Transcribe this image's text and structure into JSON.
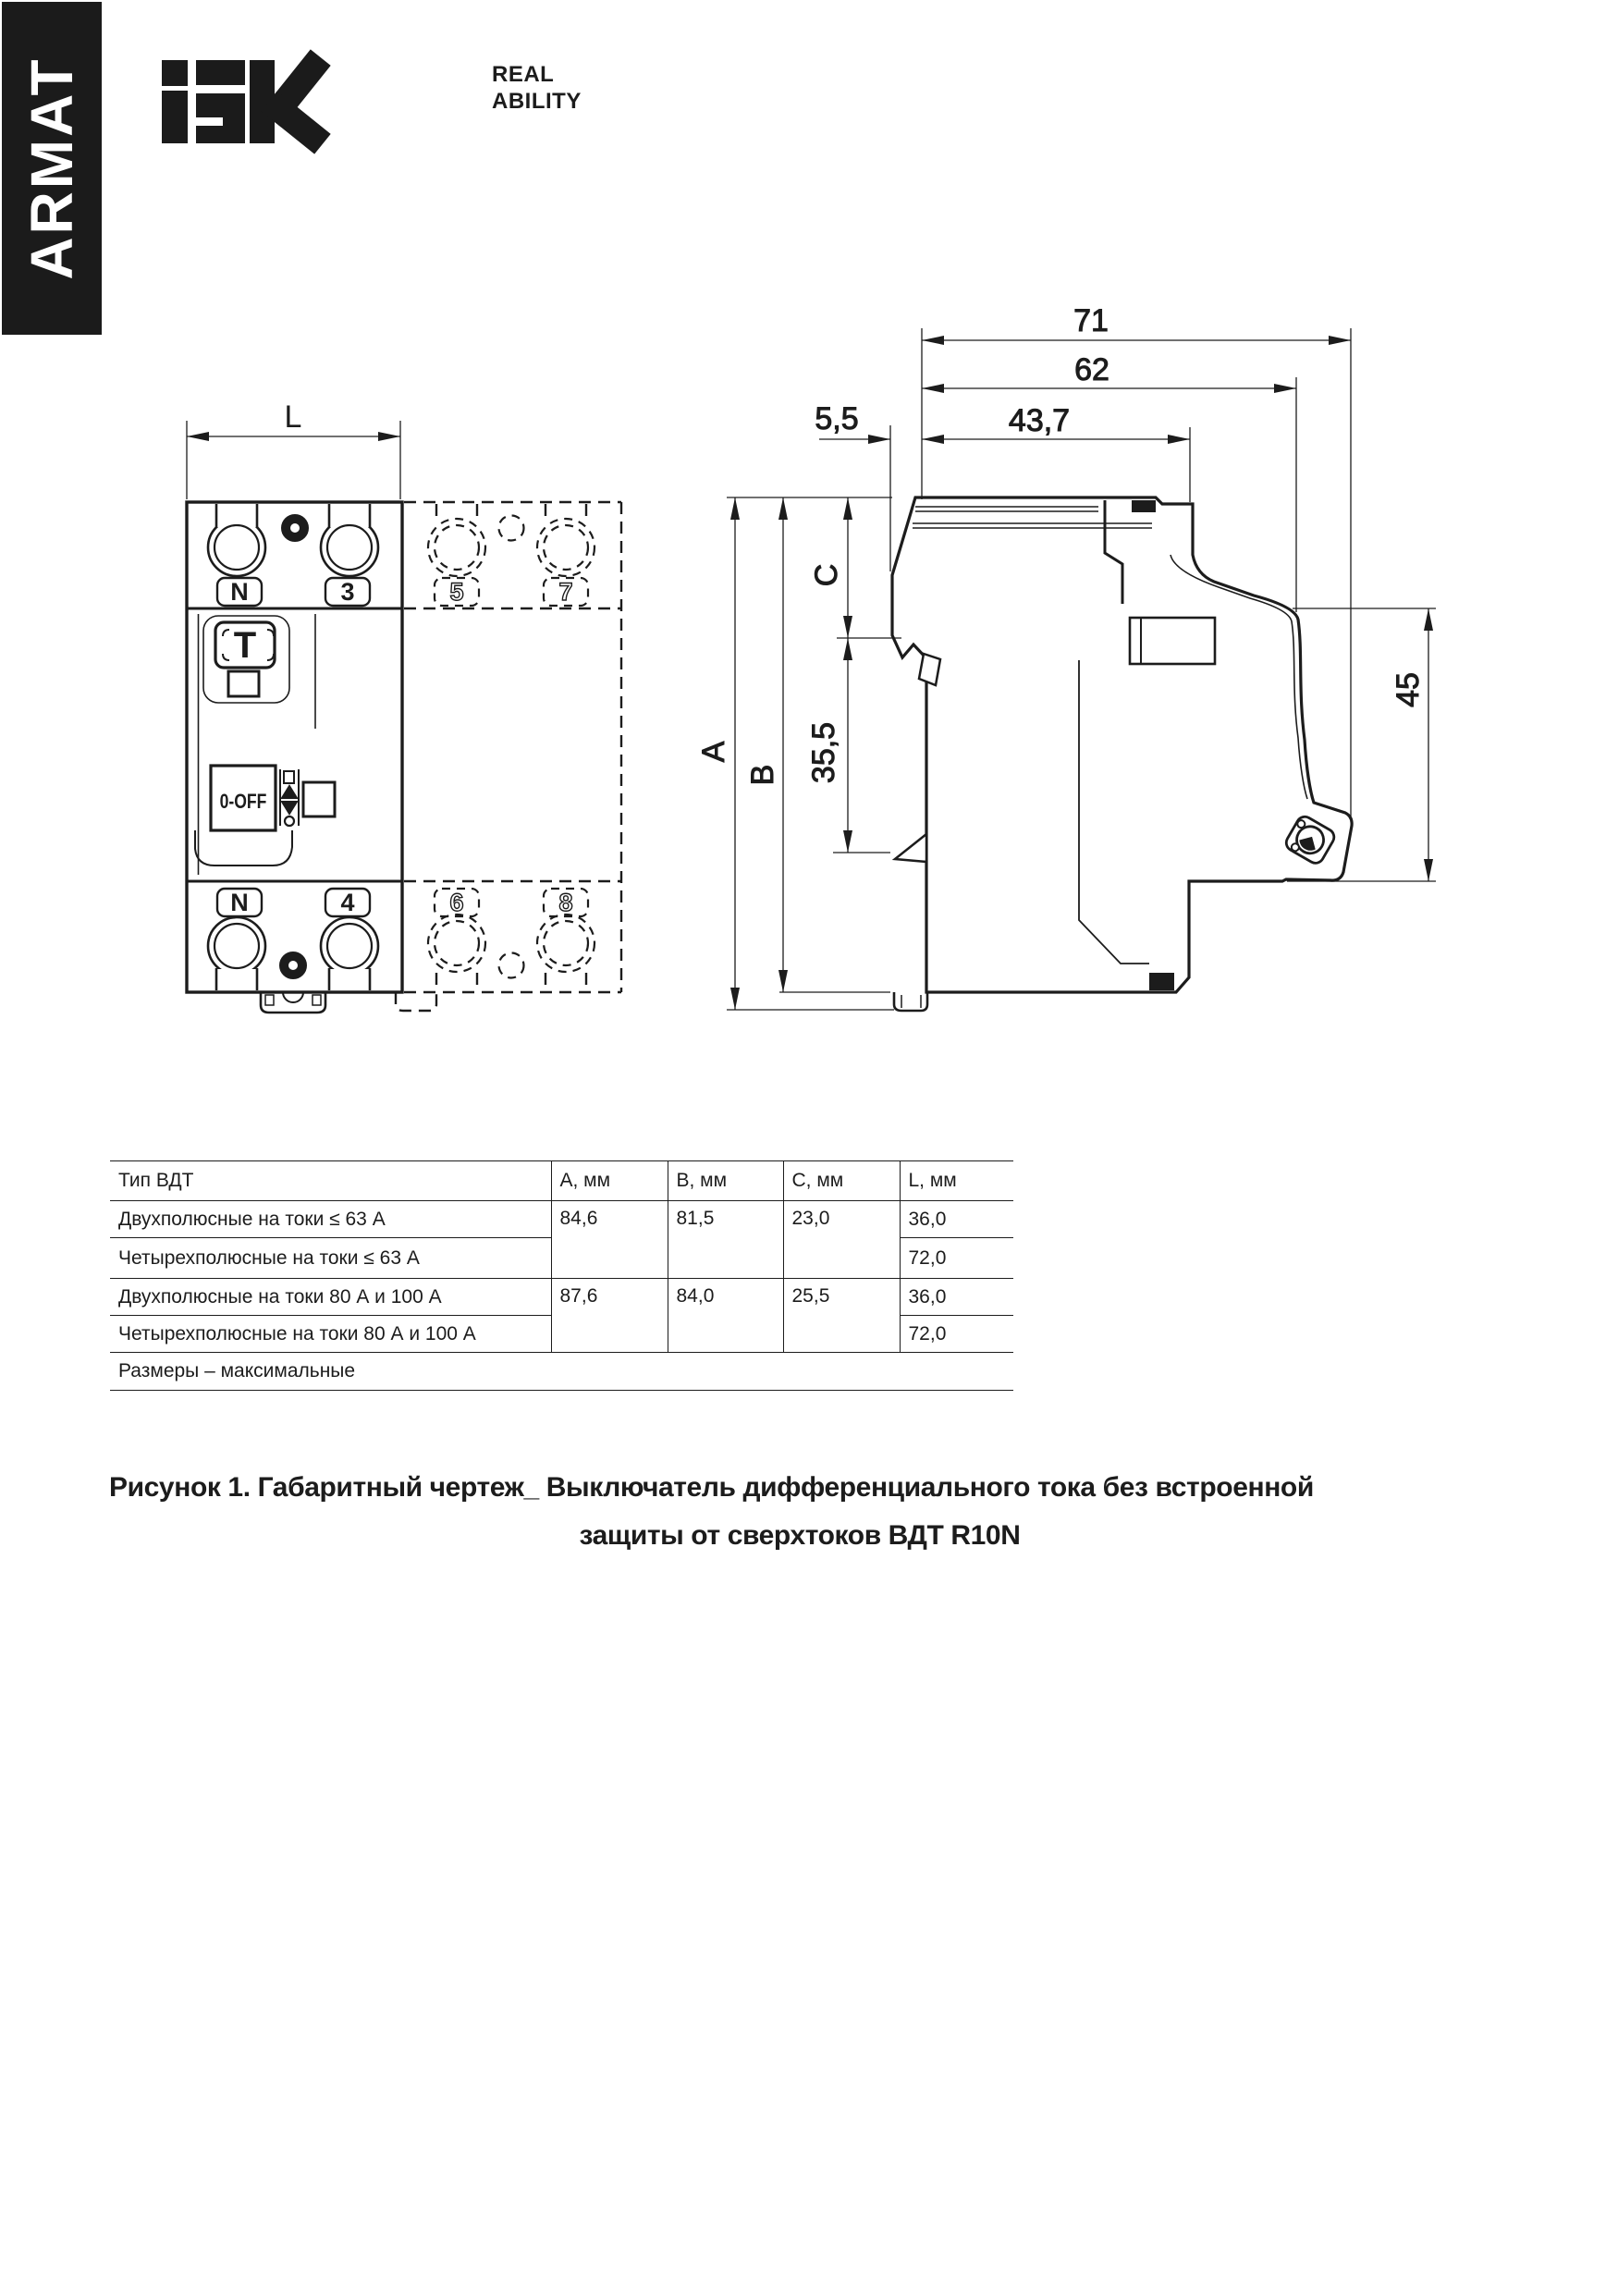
{
  "colors": {
    "ink": "#1c1c1c",
    "bg": "#ffffff"
  },
  "banner": {
    "brand": "ARMAT"
  },
  "logo": {
    "tagline1": "REAL",
    "tagline2": "ABILITY"
  },
  "front_view": {
    "dim_width": "L",
    "pole1": {
      "top_terminals": [
        "N",
        "3"
      ],
      "bottom_terminals": [
        "N",
        "4"
      ],
      "test_button": "T",
      "switch_label": "0-OFF"
    },
    "pole2": {
      "top_terminals": [
        "5",
        "7"
      ],
      "bottom_terminals": [
        "6",
        "8"
      ]
    }
  },
  "side_view": {
    "dim_71": "71",
    "dim_62": "62",
    "dim_437": "43,7",
    "dim_55": "5,5",
    "dim_45": "45",
    "dim_355": "35,5",
    "dim_A": "A",
    "dim_B": "B",
    "dim_C": "C"
  },
  "table": {
    "headers": [
      "Тип ВДТ",
      "А, мм",
      "В, мм",
      "С, мм",
      "L, мм"
    ],
    "rows": [
      {
        "type": "Двухполюсные на токи ≤ 63 А",
        "a": "84,6",
        "b": "81,5",
        "c": "23,0",
        "l": "36,0"
      },
      {
        "type": "Четырехполюсные на токи ≤ 63 А",
        "l": "72,0"
      },
      {
        "type": "Двухполюсные на токи 80 А и 100 А",
        "a": "87,6",
        "b": "84,0",
        "c": "25,5",
        "l": "36,0"
      },
      {
        "type": "Четырехполюсные на токи 80 А и 100 А",
        "l": "72,0"
      }
    ],
    "footnote": "Размеры – максимальные"
  },
  "caption": {
    "line1": "Рисунок 1. Габаритный чертеж_ Выключатель дифференциального тока без встроенной",
    "line2": "защиты от сверхтоков ВДТ R10N"
  }
}
